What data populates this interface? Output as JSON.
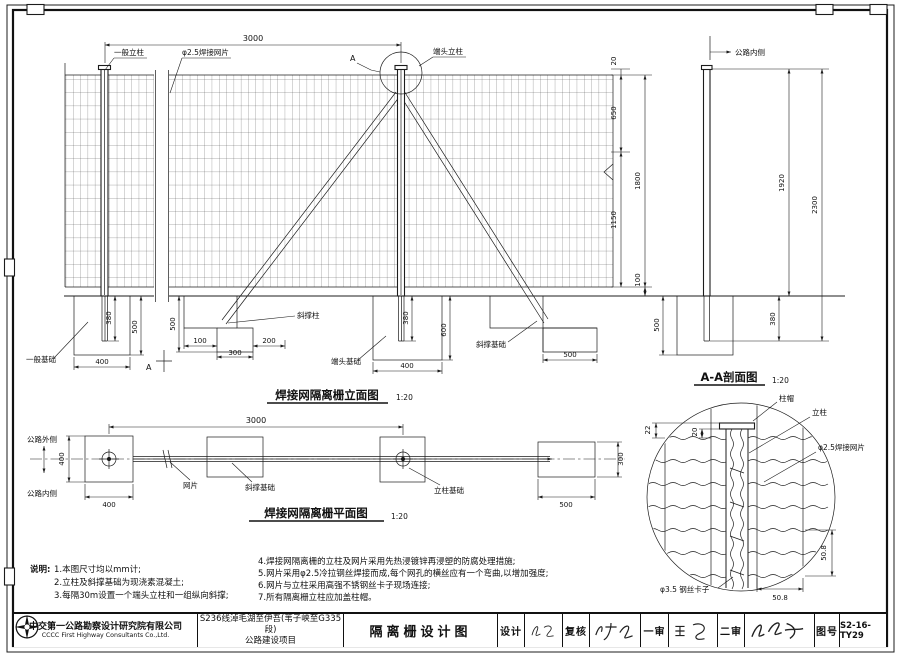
{
  "titles": {
    "elevation": "焊接网隔离栅立面图",
    "elevation_scale": "1:20",
    "plan": "焊接网隔离栅平面图",
    "plan_scale": "1:20",
    "section": "A-A剖面图",
    "section_scale": "1:20"
  },
  "elev": {
    "general_post": "一般立柱",
    "mesh_label": "φ2.5焊接网片",
    "detail_a": "A",
    "end_post": "端头立柱",
    "brace_post": "斜撑柱",
    "general_found": "一般基础",
    "end_found": "端头基础",
    "brace_found": "斜撑基础",
    "section_a": "A",
    "d_span": "3000",
    "d_cap": "20",
    "d_upper": "650",
    "d_lower": "1150",
    "d_mesh": "1800",
    "d_gap": "100",
    "d_gf_embed": "380",
    "d_gf_depth": "500",
    "d_gf_w": "400",
    "d_bf_depth": "500",
    "d_bf_a": "100",
    "d_bf_b": "300",
    "d_bf_c": "200",
    "d_ef_embed": "380",
    "d_ef_depth": "600",
    "d_ef_w": "400",
    "d_bf2_w": "500"
  },
  "section": {
    "road_inside": "公路内侧",
    "d_above": "1920",
    "d_total": "2300",
    "d_depth": "500",
    "d_embed": "380"
  },
  "plan": {
    "road_outside": "公路外侧",
    "road_inside": "公路内侧",
    "mesh": "网片",
    "brace_found": "斜撑基础",
    "post_found": "立柱基础",
    "d_span": "3000",
    "d_w": "400",
    "d_h": "400",
    "d_end_w": "500",
    "d_end_h": "300"
  },
  "detail": {
    "cap": "柱帽",
    "post": "立柱",
    "mesh": "φ2.5焊接网片",
    "clip": "φ3.5 钢丝卡子",
    "d_22": "22",
    "d_20": "20",
    "d_v": "50.8",
    "d_h": "50.8"
  },
  "notes": {
    "heading": "说明:",
    "l1": "1.本图尺寸均以mm计;",
    "l2": "2.立柱及斜撑基础为现浇素混凝土;",
    "l3": "3.每隔30m设置一个端头立柱和一组纵向斜撑;",
    "r1": "4.焊接网隔离栅的立柱及网片采用先热浸镀锌再浸塑的防腐处理措施;",
    "r2": "5.网片采用φ2.5冷拉钢丝焊接而成,每个网孔的横丝应有一个弯曲,以增加强度;",
    "r3": "6.网片与立柱采用高强不锈钢丝卡子现场连接;",
    "r4": "7.所有隔离栅立柱应加盖柱帽。"
  },
  "tb": {
    "company_cn": "中交第一公路勘察设计研究院有限公司",
    "company_en": "CCCC First Highway Consultants Co.,Ltd.",
    "project1": "S236线淖毛湖至伊吾(苇子峡至G335段)",
    "project2": "公路建设项目",
    "title": "隔离栅设计图",
    "design": "设计",
    "check": "复核",
    "review1": "一审",
    "review2": "二审",
    "no_label": "图号",
    "no": "S2-16-TY29"
  }
}
